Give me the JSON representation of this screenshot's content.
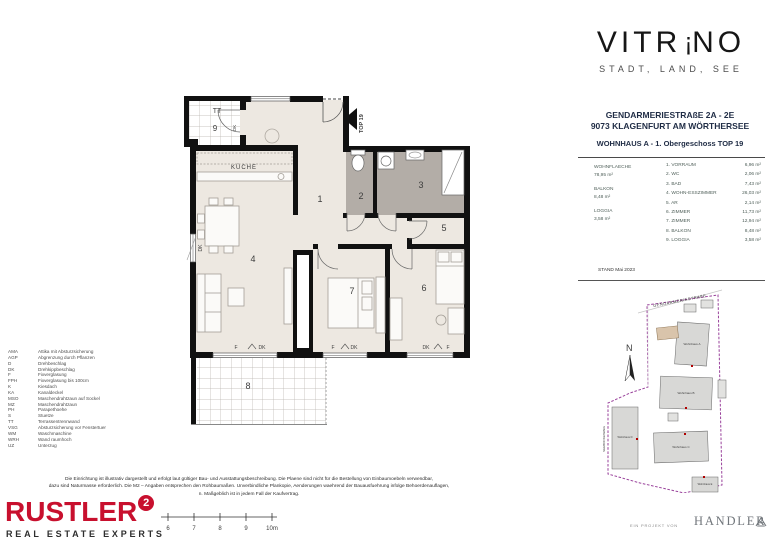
{
  "brand": {
    "logo_pre": "VITR",
    "logo_mark": "!",
    "logo_post": "NO",
    "tagline": "STADT, LAND, SEE"
  },
  "info": {
    "address_line1": "GENDARMERIESTRAßE 2A - 2E",
    "address_line2": "9073 KLAGENFURT AM WÖRTHERSEE",
    "unit_title": "WOHNHAUS A - 1. Obergeschoss TOP 19",
    "summary": [
      {
        "label": "WOHNFLAECHE",
        "value": "78,95 m²"
      },
      {
        "label": "BALKON",
        "value": "8,48 m²"
      },
      {
        "label": "LOGGIA",
        "value": "3,58 m²"
      }
    ],
    "rooms": [
      {
        "name": "1. VORRAUM",
        "area": "6,96 m²"
      },
      {
        "name": "2. WC",
        "area": "2,06 m²"
      },
      {
        "name": "3. BAD",
        "area": "7,43 m²"
      },
      {
        "name": "4. WOHN-ESSZIMMER",
        "area": "26,03 m²"
      },
      {
        "name": "5. AR",
        "area": "2,14 m²"
      },
      {
        "name": "6. ZIMMER",
        "area": "11,73 m²"
      },
      {
        "name": "7. ZIMMER",
        "area": "12,94 m²"
      },
      {
        "name": "8. BALKON",
        "area": "8,48 m²"
      },
      {
        "name": "9. LOGGIA",
        "area": "3,58 m²"
      }
    ],
    "stand": "STAND Mai 2023"
  },
  "floorplan": {
    "numbers": [
      "1",
      "2",
      "3",
      "4",
      "5",
      "6",
      "7",
      "8",
      "9"
    ],
    "labels": {
      "kueche": "KÜCHE",
      "tt": "TT",
      "top": "TOP 19",
      "f": "F",
      "dk": "DK"
    }
  },
  "legend": [
    {
      "abbr": "AMA",
      "text": "Attika mit Absturzsicherung"
    },
    {
      "abbr": "AGP",
      "text": "Abgrenzung durch Pflanzen"
    },
    {
      "abbr": "D",
      "text": "Drehbeschlag"
    },
    {
      "abbr": "DK",
      "text": "Drehkippbeschlag"
    },
    {
      "abbr": "F",
      "text": "Fixverglasung"
    },
    {
      "abbr": "FPH",
      "text": "Fixverglasung bis 100cm"
    },
    {
      "abbr": "K",
      "text": "Kiesdach"
    },
    {
      "abbr": "KA",
      "text": "Kanaldeckel"
    },
    {
      "abbr": "MSO",
      "text": "Maschendrahtzaun auf Sockel"
    },
    {
      "abbr": "MZ",
      "text": "Maschendrahtzaun"
    },
    {
      "abbr": "PH",
      "text": "Parapethoehe"
    },
    {
      "abbr": "S",
      "text": "Stuetze"
    },
    {
      "abbr": "TT",
      "text": "Terrassentrennwand"
    },
    {
      "abbr": "VSG",
      "text": "Absturzsicherung vor Fenstertuer"
    },
    {
      "abbr": "WM",
      "text": "Waschmaschine"
    },
    {
      "abbr": "WRH",
      "text": "Wand raumhoch"
    },
    {
      "abbr": "UZ",
      "text": "Unterzug"
    }
  ],
  "disclaimer": {
    "line1": "Die Einrichtung ist illustrativ dargestellt und erfolgt laut gültiger Bau- und Ausstattungsbeschreibung. Die Plaene sind nicht für die Bestellung von Einbaumoebeln verwendbar,",
    "line2": "dazu sind Naturmasse erforderlich. Die M2 – Angaben entsprechen den Rohbaumaßen. Unverbindliche Plankopie, Aenderungen waehrend der Bauausfuehrung infolge Behoerdenauflagen,",
    "line3": "n. Maßgeblich ist in jedem Fall der Kaufvertrag."
  },
  "rustler": {
    "name": "RUSTLER",
    "sup": "2",
    "subtitle": "REAL ESTATE EXPERTS",
    "color": "#c8102e"
  },
  "scalebar": {
    "ticks": [
      "6",
      "7",
      "8",
      "9",
      "10m"
    ]
  },
  "siteplan": {
    "street_top": "GENDARMERIESTRAßE",
    "street_left": "SEEBOCKENWEG",
    "north": "N",
    "buildings": [
      "Wohnhaus A",
      "Wohnhaus B",
      "Wohnhaus C",
      "Wohnhaus D",
      "Wohnhaus E"
    ],
    "boundary_color": "#99419b"
  },
  "footer": {
    "prefix": "EIN PROJEKT VON",
    "developer": "HANDLER"
  }
}
